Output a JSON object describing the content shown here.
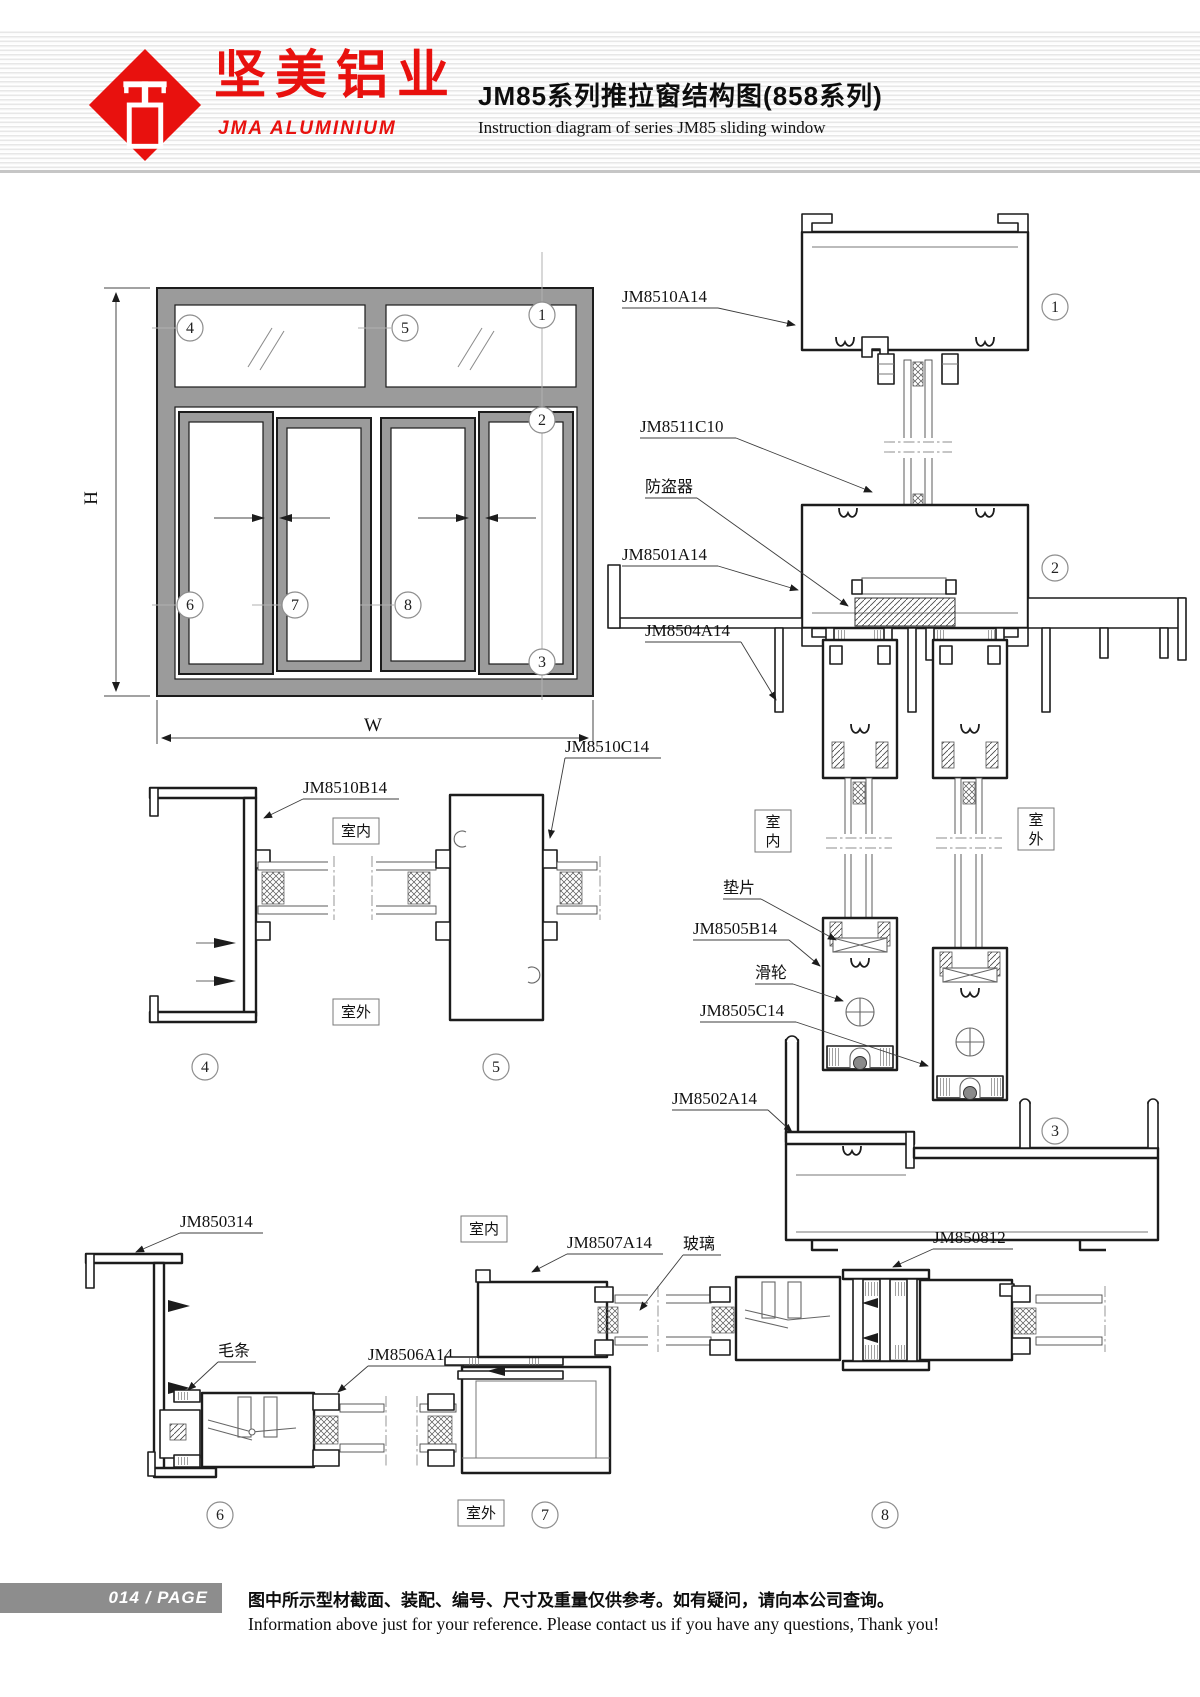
{
  "header": {
    "brand_cn": "坚美铝业",
    "brand_en": "JMA  ALUMINIUM",
    "title_cn": "JM85系列推拉窗结构图(858系列)",
    "title_en": "Instruction diagram of series JM85 sliding window"
  },
  "drawing": {
    "dim_h": "H",
    "dim_w": "W",
    "indoor": "室内",
    "outdoor": "室外",
    "indoor_chars": [
      "室",
      "内"
    ],
    "outdoor_chars": [
      "室",
      "外"
    ],
    "circles": [
      "1",
      "2",
      "3",
      "4",
      "5",
      "6",
      "7",
      "8"
    ],
    "parts": {
      "top_frame": "JM8510A14",
      "glazing_bead": "JM8511C10",
      "anti_theft": "防盗器",
      "mid_frame": "JM8501A14",
      "track": "JM8504A14",
      "shim": "垫片",
      "sash_bottom": "JM8505B14",
      "roller": "滑轮",
      "sash_profile": "JM8505C14",
      "sill": "JM8502A14",
      "side_frame": "JM8510B14",
      "sash_stile": "JM8510C14",
      "cover": "JM850314",
      "brush": "毛条",
      "bottom_sash": "JM8506A14",
      "jamb": "JM8507A14",
      "glass": "玻璃",
      "interlock": "JM850812"
    }
  },
  "footer": {
    "page_label": "014 / PAGE",
    "note_cn": "图中所示型材截面、装配、编号、尺寸及重量仅供参考。如有疑问，请向本公司查询。",
    "note_en": "Information above just for your reference. Please contact us if you have any questions, Thank you!"
  },
  "colors": {
    "brand_red": "#e8110e",
    "ink": "#1c1c1c",
    "frame_gray": "#9b9b9b",
    "footer_bar": "#8d8d8d"
  }
}
